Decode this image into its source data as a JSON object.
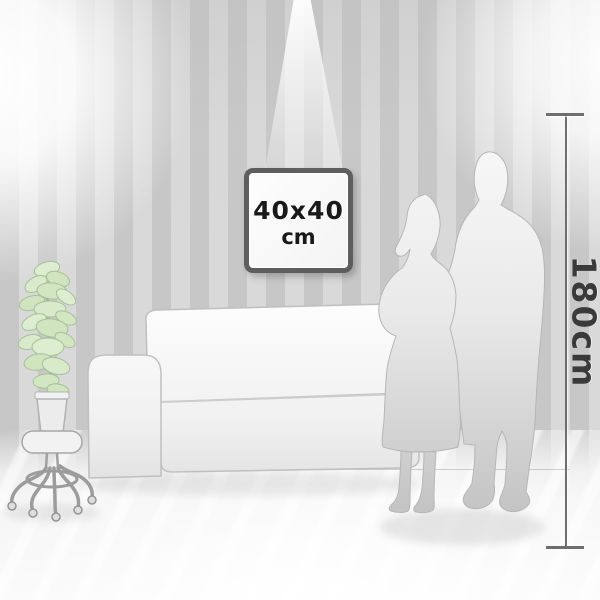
{
  "frame": {
    "size_label": "40x40",
    "unit_label": "cm"
  },
  "measure": {
    "height_label": "180cm"
  },
  "palette": {
    "wall_stripe_dark": "#c7c7c7",
    "wall_stripe_light": "#d9d9d9",
    "floor": "#f7f7f7",
    "frame_border": "#5e5e5e",
    "frame_face": "#f9f9f9",
    "frame_text": "#191919",
    "measure_line": "#6e6e6e",
    "measure_text": "#3a3a3a",
    "plant_leaf": "#d5e8c7",
    "silhouette": "#dfdfdf"
  },
  "objects": {
    "wall": "striped-showroom-wall",
    "artwork": "square-frame-40x40",
    "sofa": "white-sofa",
    "plant": "potted-plant-on-caster-stool",
    "couple": "standing-couple-silhouette",
    "ruler": "height-reference-180cm"
  }
}
